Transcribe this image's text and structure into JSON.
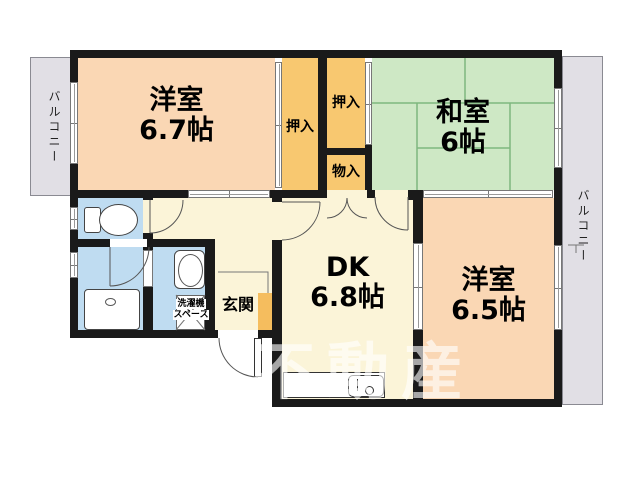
{
  "rooms": {
    "west1": {
      "name": "洋室",
      "size": "6.7帖"
    },
    "washitsu": {
      "name": "和室",
      "size": "6帖"
    },
    "dk": {
      "name": "DK",
      "size": "6.8帖"
    },
    "west2": {
      "name": "洋室",
      "size": "6.5帖"
    },
    "genkan": {
      "label": "玄関"
    },
    "closet_left": {
      "label": "押入"
    },
    "closet_right": {
      "label": "押入"
    },
    "storage": {
      "label": "物入"
    },
    "laundry": {
      "label_line1": "洗濯機",
      "label_line2": "スペース"
    },
    "balcony_left": {
      "label": "バルコニー"
    },
    "balcony_right": {
      "label": "バルコニー"
    }
  },
  "watermark": {
    "text": "不動産"
  },
  "colors": {
    "western_room": "#FAD7B4",
    "japanese_room": "#CEE8C5",
    "closet": "#F8C870",
    "dk_hall": "#FBF4D8",
    "wet_rooms": "#BFDCF1",
    "balcony": "#E1DFE5",
    "genkan_step": "#F5BD5E",
    "wall": "#1A1A1A",
    "tatami_line": "#7FB77F"
  }
}
